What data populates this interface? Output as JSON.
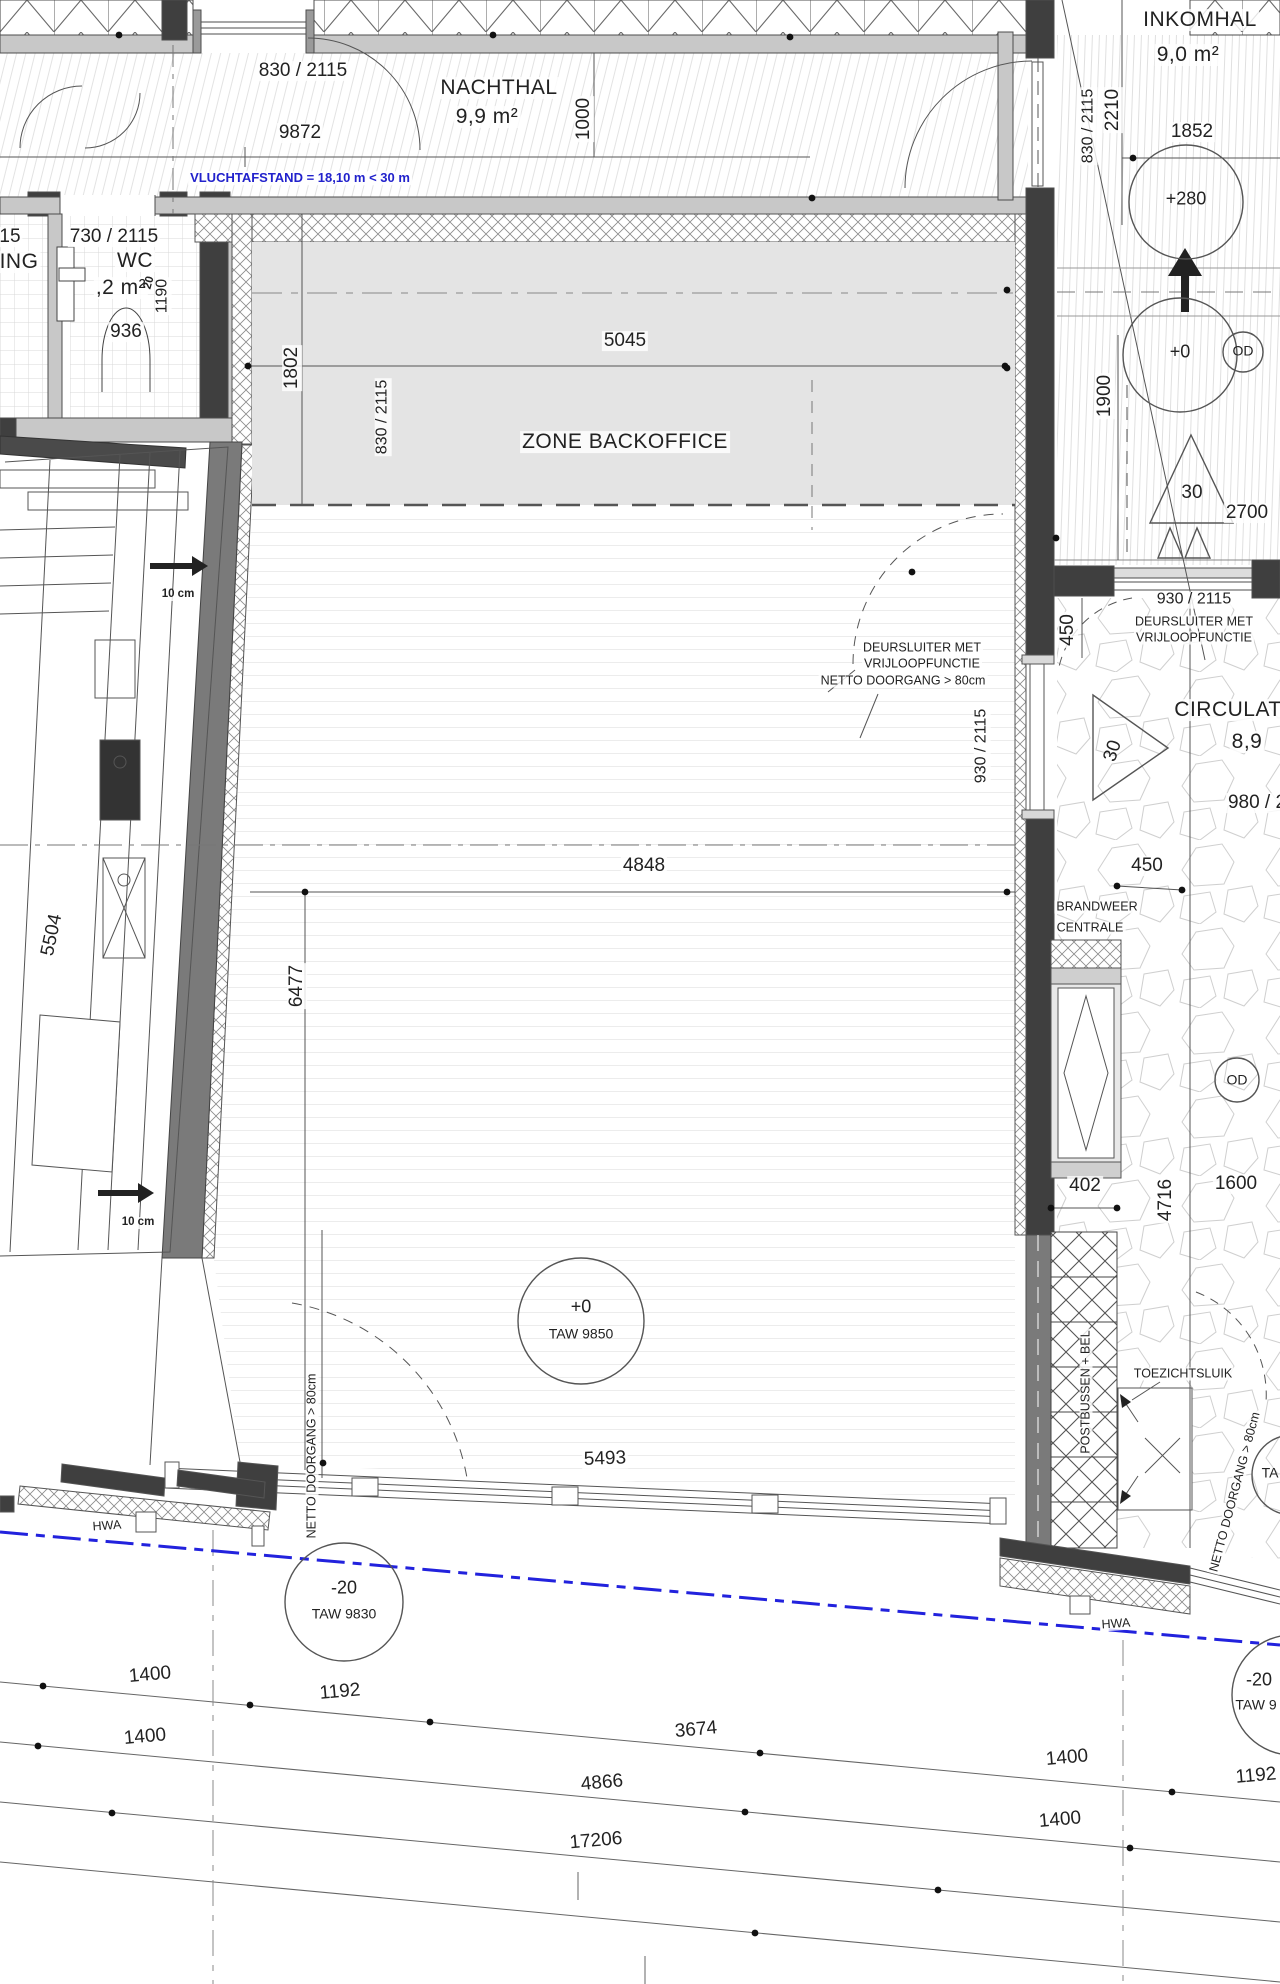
{
  "plan": {
    "rooms": {
      "nachthal": {
        "name": "NACHTHAL",
        "area": "9,9 m²"
      },
      "inkomhal": {
        "name": "INKOMHAL",
        "area": "9,0 m²"
      },
      "wc": {
        "name": "WC",
        "area": ",2 m²"
      },
      "adjacent_room_partial": "ING",
      "zone_backoffice": "ZONE BACKOFFICE",
      "circulatie": {
        "name": "CIRCULAT",
        "area": "8,9"
      }
    },
    "door_sizes": {
      "top_hall_door": "830 / 2115",
      "wc_door": "730 / 2115",
      "wc_opening": "936",
      "inkomhal_door": "830 / 2115",
      "backoffice_door": "830 / 2115",
      "main_room_door": "930 / 2115",
      "circulatie_door": "930 / 2115",
      "circulatie_door_partial": "980 / 2"
    },
    "dimensions": {
      "hall_width": "9872",
      "hall_depth": "1000",
      "inkomhal_depth": "2210",
      "inkomhal_width": "1852",
      "left_partial": "15",
      "wc_depth": "1190",
      "wc_small": "20",
      "zone_width": "5045",
      "zone_depth": "1802",
      "entry_width": "1900",
      "spot_a": "30",
      "spot_b": "30",
      "entry_run": "2700",
      "door_offset_v": "450",
      "niche_width": "450",
      "room_width": "4848",
      "room_depth": "6477",
      "machine_length": "5504",
      "cabinet_offset": "402",
      "circulatie_depth": "4716",
      "circulatie_width": "1600",
      "facade_width": "5493",
      "site_a": "1400",
      "site_b": "1192",
      "site_c": "1400",
      "site_d": "3674",
      "site_e": "4866",
      "site_f": "17206",
      "site_g": "1400",
      "site_h": "1192",
      "site_i": "1400"
    },
    "annotations": {
      "vluchtafstand": "VLUCHTAFSTAND = 18,10 m < 30 m",
      "deursluiter_1": "DEURSLUITER MET",
      "deursluiter_2": "VRIJLOOPFUNCTIE",
      "netto_doorgang": "NETTO DOORGANG > 80cm",
      "brandweer_1": "BRANDWEER",
      "brandweer_2": "CENTRALE",
      "postbussen": "POSTBUSSEN + BEL",
      "toezichtsluik": "TOEZICHTSLUIK",
      "hwa": "HWA",
      "offset_10cm": "10 cm"
    },
    "levels": {
      "plus280": "+280",
      "plus0": "+0",
      "taw_9850": "TAW 9850",
      "minus20": "-20",
      "taw_9830": "TAW 9830",
      "taw_9_clipped": "TAW 9",
      "od": "OD",
      "ta_clipped": "TA"
    },
    "colors": {
      "annotation_blue": "#2222cc",
      "wall_dark": "#3f3f3f",
      "wall_light": "#c8c8c8",
      "zone_gray": "#e4e4e4"
    }
  }
}
